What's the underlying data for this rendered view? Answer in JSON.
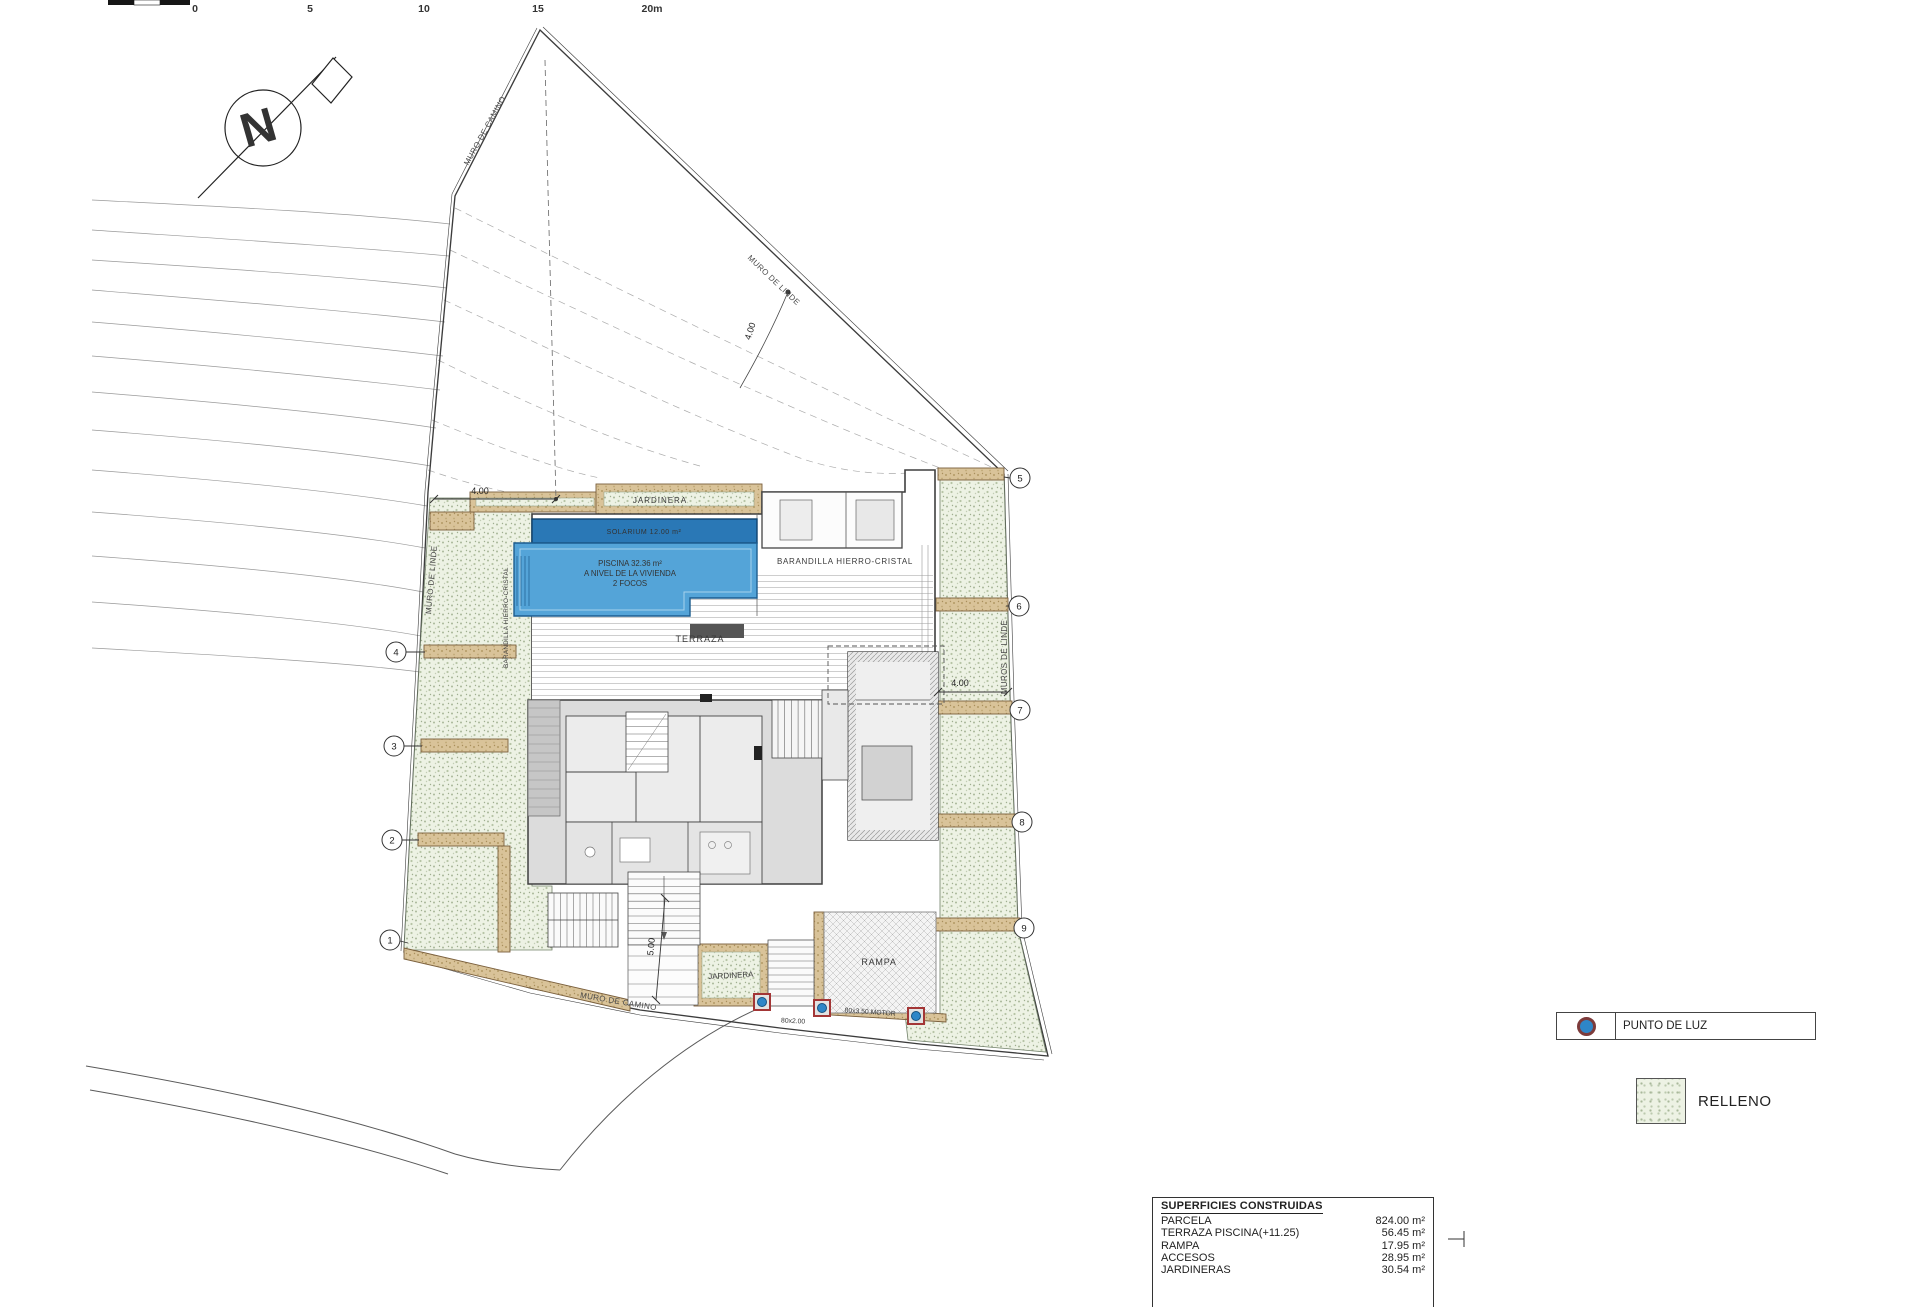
{
  "scale_bar": {
    "ticks": [
      "0",
      "5",
      "10",
      "15",
      "20m"
    ]
  },
  "north_letter": "N",
  "boundary": {
    "muro_camino_top": "MURO DE CAMINO",
    "muro_linde_top": "MURO DE LINDE",
    "muro_linde_left": "MURO DE LINDE",
    "muros_linde_right": "MUROS DE LINDE",
    "muro_camino_bottom": "MURO DE CAMINO"
  },
  "markers": [
    "1",
    "2",
    "3",
    "4",
    "5",
    "6",
    "7",
    "8",
    "9"
  ],
  "dimensions": {
    "top": "4.00",
    "left": "4.00",
    "right": "4.00",
    "bottom": "5.00"
  },
  "site": {
    "jardinera_top": "JARDINERA",
    "jardinera_bottom": "JARDINERA",
    "solarium": "SOLARIUM 12.00 m²",
    "piscina": [
      "PISCINA 32.36 m²",
      "A NIVEL DE LA VIVIENDA",
      "2 FOCOS"
    ],
    "barandilla_top": "BARANDILLA HIERRO-CRISTAL",
    "barandilla_left": "BARANDILLA HIERRO-CRISTAL",
    "terraza": "TERRAZA",
    "rampa": "RAMPA",
    "light_1": "80x2.00",
    "light_2": "80x3.50 MOTOR"
  },
  "legend": {
    "punto_de_luz": "PUNTO DE LUZ",
    "relleno": "RELLENO"
  },
  "surfaces_table": {
    "title": "SUPERFICIES CONSTRUIDAS",
    "rows": [
      {
        "label": "PARCELA",
        "value": "824.00 m²"
      },
      {
        "label": "TERRAZA PISCINA(+11.25)",
        "value": "56.45 m²"
      },
      {
        "label": "RAMPA",
        "value": "17.95 m²"
      },
      {
        "label": "ACCESOS",
        "value": "28.95 m²"
      },
      {
        "label": "JARDINERAS",
        "value": "30.54 m²"
      }
    ]
  },
  "colors": {
    "pool": "#54a4d8",
    "solarium_band": "#2a78b6",
    "relleno_bg": "#edf2e4",
    "wall_tan": "#d9c399",
    "light_point": "#2e86c8"
  }
}
